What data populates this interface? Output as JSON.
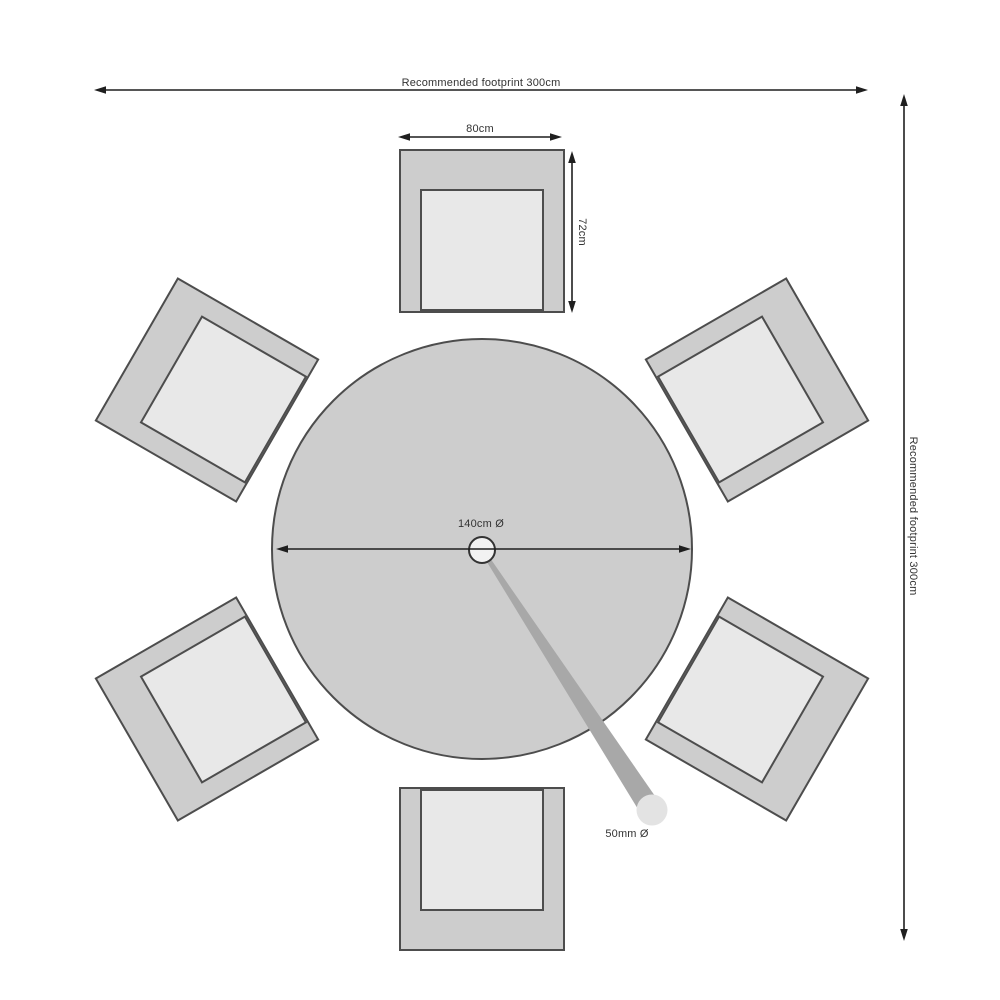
{
  "labels": {
    "footprint_horizontal": "Recommended footprint 300cm",
    "footprint_vertical": "Recommended footprint 300cm",
    "chair_width": "80cm",
    "chair_depth": "72cm",
    "table_diameter": "140cm Ø",
    "pole_diameter": "50mm Ø"
  },
  "scene": {
    "table_shape": "round",
    "chair_count": 6
  },
  "colors": {
    "background": "#ffffff",
    "furniture_fill": "#cdcdcd",
    "seat_fill": "#e8e8e8",
    "outline": "#4d4d4d",
    "dimension_line": "#1f1f1f",
    "text": "#333333",
    "pole_fill": "#a8a8a8",
    "pole_end_fill": "#e3e3e3",
    "hole_fill": "#f2f2f2"
  }
}
